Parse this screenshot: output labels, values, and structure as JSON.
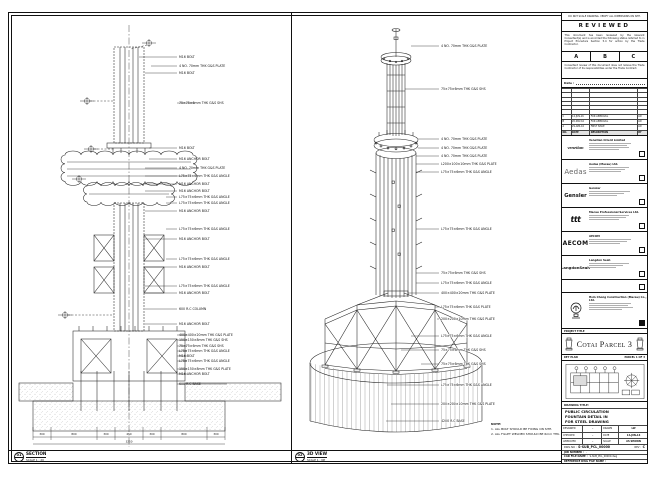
{
  "stamp": {
    "disclaimer": "DO NOT SCALE DRAWING. VERIFY ALL DIMENSIONS ON SITE.",
    "title": "REVIEWED",
    "body1": "This document has been reviewed by the relevant Consultant(s) and is accorded the following status referred to in Project Procedure Section 5.4 for action by the Trade Contractor.",
    "grades": {
      "a": "A",
      "b": "B",
      "c": "C"
    },
    "body2": "Consultant review of this document does not relieve the Trade Contractor of its responsibilities under the Trade Contract.",
    "date_label": "Date :"
  },
  "revisions": {
    "header": {
      "no": "NO.",
      "date": "DATE",
      "description": "DESCRIPTION",
      "by": "BY"
    },
    "rows": [
      {
        "no": "C",
        "date": "14-JUN-16",
        "description": "FOR APPROVAL",
        "by": "LW"
      },
      {
        "no": "B",
        "date": "20-MAY-16",
        "description": "FOR APPROVAL",
        "by": "LW"
      },
      {
        "no": "A",
        "date": "29-APR-16",
        "description": "FIRST ISSUE",
        "by": "LW"
      }
    ]
  },
  "consultants": [
    {
      "logo": "venetian",
      "name": "Venetian Orient Limited"
    },
    {
      "logo": "Aedas",
      "name": "Aedas (Macau) Ltd."
    },
    {
      "logo": "Gensler",
      "name": "Gensler"
    },
    {
      "logo": "ttt",
      "name": "Macau Professional Services Ltd."
    },
    {
      "logo": "AECOM",
      "name": "AECOM"
    },
    {
      "logo": "LangdonSeah",
      "name": "Langdon Seah"
    }
  ],
  "contractor": {
    "name": "Hsin Chong Construction (Macau) Co., Ltd."
  },
  "project": {
    "label": "PROJECT TITLE",
    "name": "Cotai Parcel 3"
  },
  "key_plan": {
    "label": "KEY PLAN",
    "ref": "PARCEL 1 OF 3"
  },
  "title_block": {
    "drawing_title_label": "DRAWING TITLE:",
    "title_lines": {
      "l1": "PUBLIC CIRCULATION",
      "l2": "FOUNTAIN DETAIL IN",
      "l3": "FOR STEEL DRAWING"
    },
    "fields": {
      "designed_label": "DESIGNED",
      "designed": "-",
      "drawn_label": "DRAWN",
      "drawn": "LW",
      "checked_label": "CHECKED",
      "checked": "-",
      "date_label": "DATE",
      "date": "14-JUN-16",
      "approved_label": "APPROVED",
      "approved": "-",
      "scale_label": "SCALE",
      "scale": "AS SHOWN"
    },
    "dwg_no_label": "DWG NO :",
    "dwg_no": "S-SUB_PCL_00000",
    "rev_label": "REV :",
    "rev": "C",
    "job_label": "JOB NUMBER :",
    "job": "-",
    "cad_label": "CAD FILE NAME :",
    "cad": "S-SUB_PCL_00000.dwg",
    "ref_label": "REFERENCE DWG FILE NAME :"
  },
  "views": {
    "section": {
      "num": "01",
      "name": "SECTION",
      "scale": "SCALE 1 : 20"
    },
    "iso": {
      "num": "02",
      "name": "3D VIEW",
      "scale": "SCALE 1 : NP"
    }
  },
  "notes": {
    "title": "NOTE:",
    "item1": "1. ALL BOLT SHOULD BE FIXING ON SITE.",
    "item2": "2. ALL FILLET WELDED SHOULD BE 6mm THK."
  },
  "section_view": {
    "callouts": [
      "M16 BOLT",
      "4 NO. 70mm THK G&S PLATE",
      "M16 BOLT",
      "75×75×6mm THK G&S SHS",
      "M16 BOLT",
      "M16 ANCHOR BOLT",
      "4 NO. 70mm THK G&S PLATE",
      "L75×75×6mm THK G&S ANGLE",
      "M16 ANCHOR BOLT",
      "M16 ANCHOR BOLT",
      "L75×75×6mm THK G&S ANGLE",
      "L75×75×6mm THK G&S ANGLE",
      "M16 ANCHOR BOLT",
      "L75×75×6mm THK G&S ANGLE",
      "M16 ANCHOR BOLT",
      "L75×75×6mm THK G&S ANGLE",
      "M16 ANCHOR BOLT",
      "L75×75×6mm THK G&S ANGLE",
      "M16 ANCHOR BOLT",
      "600 R.C COLUMN",
      "M16 ANCHOR BOLT",
      "400×400×20mm THK G&S PLATE",
      "150×150×8mm THK G&S SHS",
      "75×75×6mm THK G&S SHS",
      "L75×75×6mm THK G&S ANGLE",
      "M16 BOLT",
      "L75×75×6mm THK G&S ANGLE",
      "150×150×8mm THK G&S PLATE",
      "M16 ANCHOR BOLT",
      "600 R.C BASE"
    ],
    "dims": [
      "300",
      "800",
      "300",
      "450",
      "300",
      "800",
      "300"
    ],
    "dim_total": "3250"
  },
  "iso_view": {
    "callouts": [
      "4 NO. 70mm THK G&S PLATE",
      "75×75×6mm THK G&S SHS",
      "4 NO. 70mm THK G&S PLATE",
      "4 NO. 70mm THK G&S PLATE",
      "4 NO. 70mm THK G&S PLATE",
      "L200×100×10mm THK G&S PLATE",
      "L75×75×6mm THK G&S ANGLE",
      "L75×75×6mm THK G&S ANGLE",
      "75×75×6mm THK G&S SHS",
      "L75×75×6mm THK G&S ANGLE",
      "400×400×20mm THK G&S PLATE",
      "L75×75×6mm THK G&S PLATE",
      "200×200×10mm THK G&S PLATE",
      "L75×75×6mm THK G&S ANGLE",
      "75×75×6mm THK G&S SHS",
      "75×75×6mm THK G&S SHS",
      "L75×75×6mm THK G&S ANGLE",
      "200×200×10mm THK G&S PLATE",
      "4200 R.C BASE"
    ]
  }
}
